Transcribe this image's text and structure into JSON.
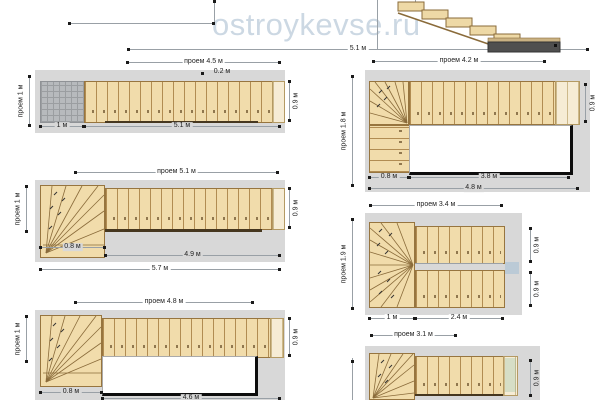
{
  "watermark": "ostroykevse.ru",
  "section_view": {
    "total_length": "5.1 м"
  },
  "plans": {
    "l1": {
      "title": "проем 4.5 м",
      "left_opening": "проем 1 м",
      "tread_depth": "0.2 м",
      "landing_len": "1 м",
      "total_len": "5.1 м",
      "flight_width": "0.9 м"
    },
    "l2": {
      "title": "проем 5.1 м",
      "left_opening": "проем 1 м",
      "winder_len": "0.8 м",
      "flight_len": "4.9 м",
      "total_len": "5.7 м",
      "flight_width": "0.9 м"
    },
    "l3": {
      "title": "проем 4.8 м",
      "left_opening": "проем 1 м",
      "winder_len": "0.8 м",
      "flight_len": "4.6 м",
      "flight_width": "0.9 м"
    },
    "r1": {
      "title": "проем 4.2 м",
      "left_opening": "проем 1.8 м",
      "winder_len": "0.8 м",
      "flight_len": "3.8 м",
      "total_len": "4.8 м",
      "flight_width": "0.9 м"
    },
    "r2": {
      "title": "проем 3.4 м",
      "left_opening": "проем 1.9 м",
      "winder_len": "1 м",
      "flight_len": "2.4 м",
      "upper_width": "0.9 м",
      "lower_width": "0.9 м"
    },
    "r3": {
      "title": "проем 3.1 м",
      "flight_width": "0.9 м"
    }
  }
}
